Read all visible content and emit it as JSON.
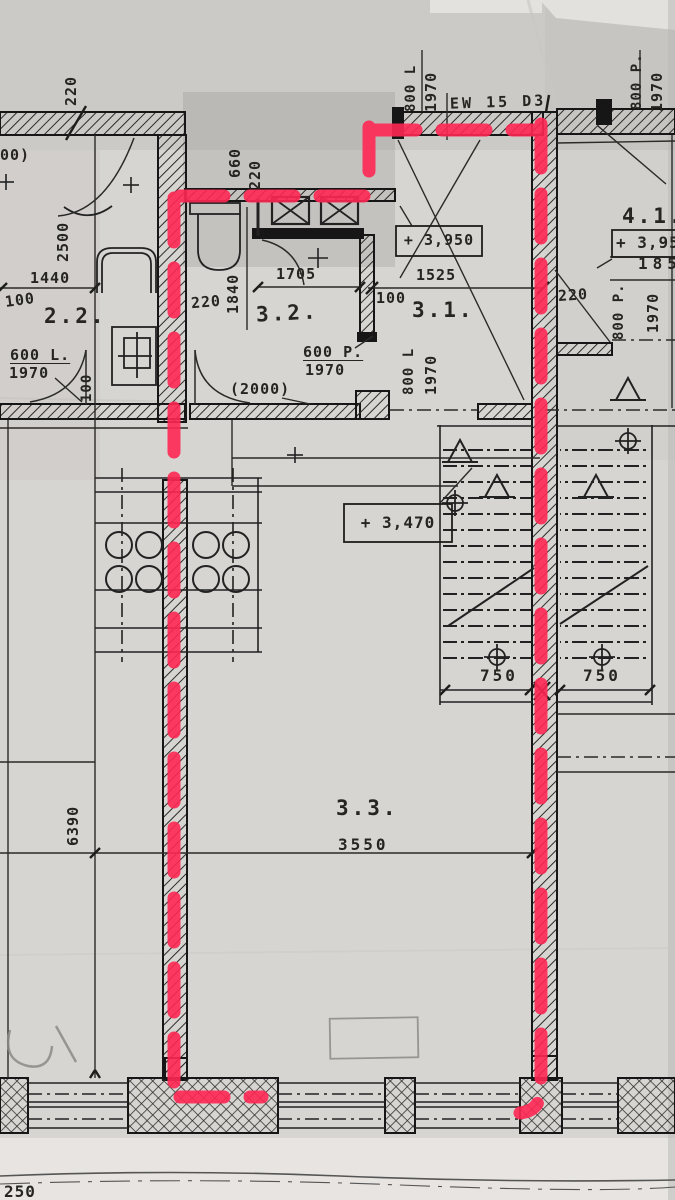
{
  "document": {
    "kind": "architectural floor plan photograph with red marker highlight",
    "sheet_scale_note": "250"
  },
  "colors": {
    "paper": "#d7d5d2",
    "ink": "#1f1f1f",
    "red_marker": "#ff2753",
    "pencil": "#8a8a86"
  },
  "labels": {
    "door_tag_top": "EW 15 D3",
    "v800L_top": "800 L",
    "v1970_top": "1970",
    "v800P_topright": "800 P.",
    "v1970_topright": "1970",
    "v220_topleft": "220",
    "dim_cut_topleft": "00)",
    "v2500": "2500",
    "dim_1440": "1440",
    "dim_100_left": "100",
    "room_22": "2.2.",
    "door_600L": "600 L.",
    "door_600L_h": "1970",
    "v100_left": "100",
    "v660": "660",
    "v220_corridor": "220",
    "dim_220_wc": "220",
    "v1840": "1840",
    "room_32": "3.2.",
    "dim_1705": "1705",
    "door_600P": "600 P.",
    "door_600P_h": "1970",
    "dim_2000": "(2000)",
    "v800L_mid": "800 L",
    "v1970_mid": "1970",
    "dim_100_mid": "100",
    "room_31": "3.1.",
    "dim_1525": "1525",
    "elev_3950": "+ 3,950",
    "elev_3470": "+ 3,470",
    "dim_220_right": "220",
    "v800P_mid": "800 P.",
    "v1970_midr": "1970",
    "room_41": "4.1.",
    "elev_395": "+ 3,95",
    "dim_185": "185",
    "dim_750_left": "750",
    "dim_750_right": "750",
    "room_33": "3.3.",
    "dim_3550": "3550",
    "v6390": "6390",
    "dim_250": "250"
  }
}
